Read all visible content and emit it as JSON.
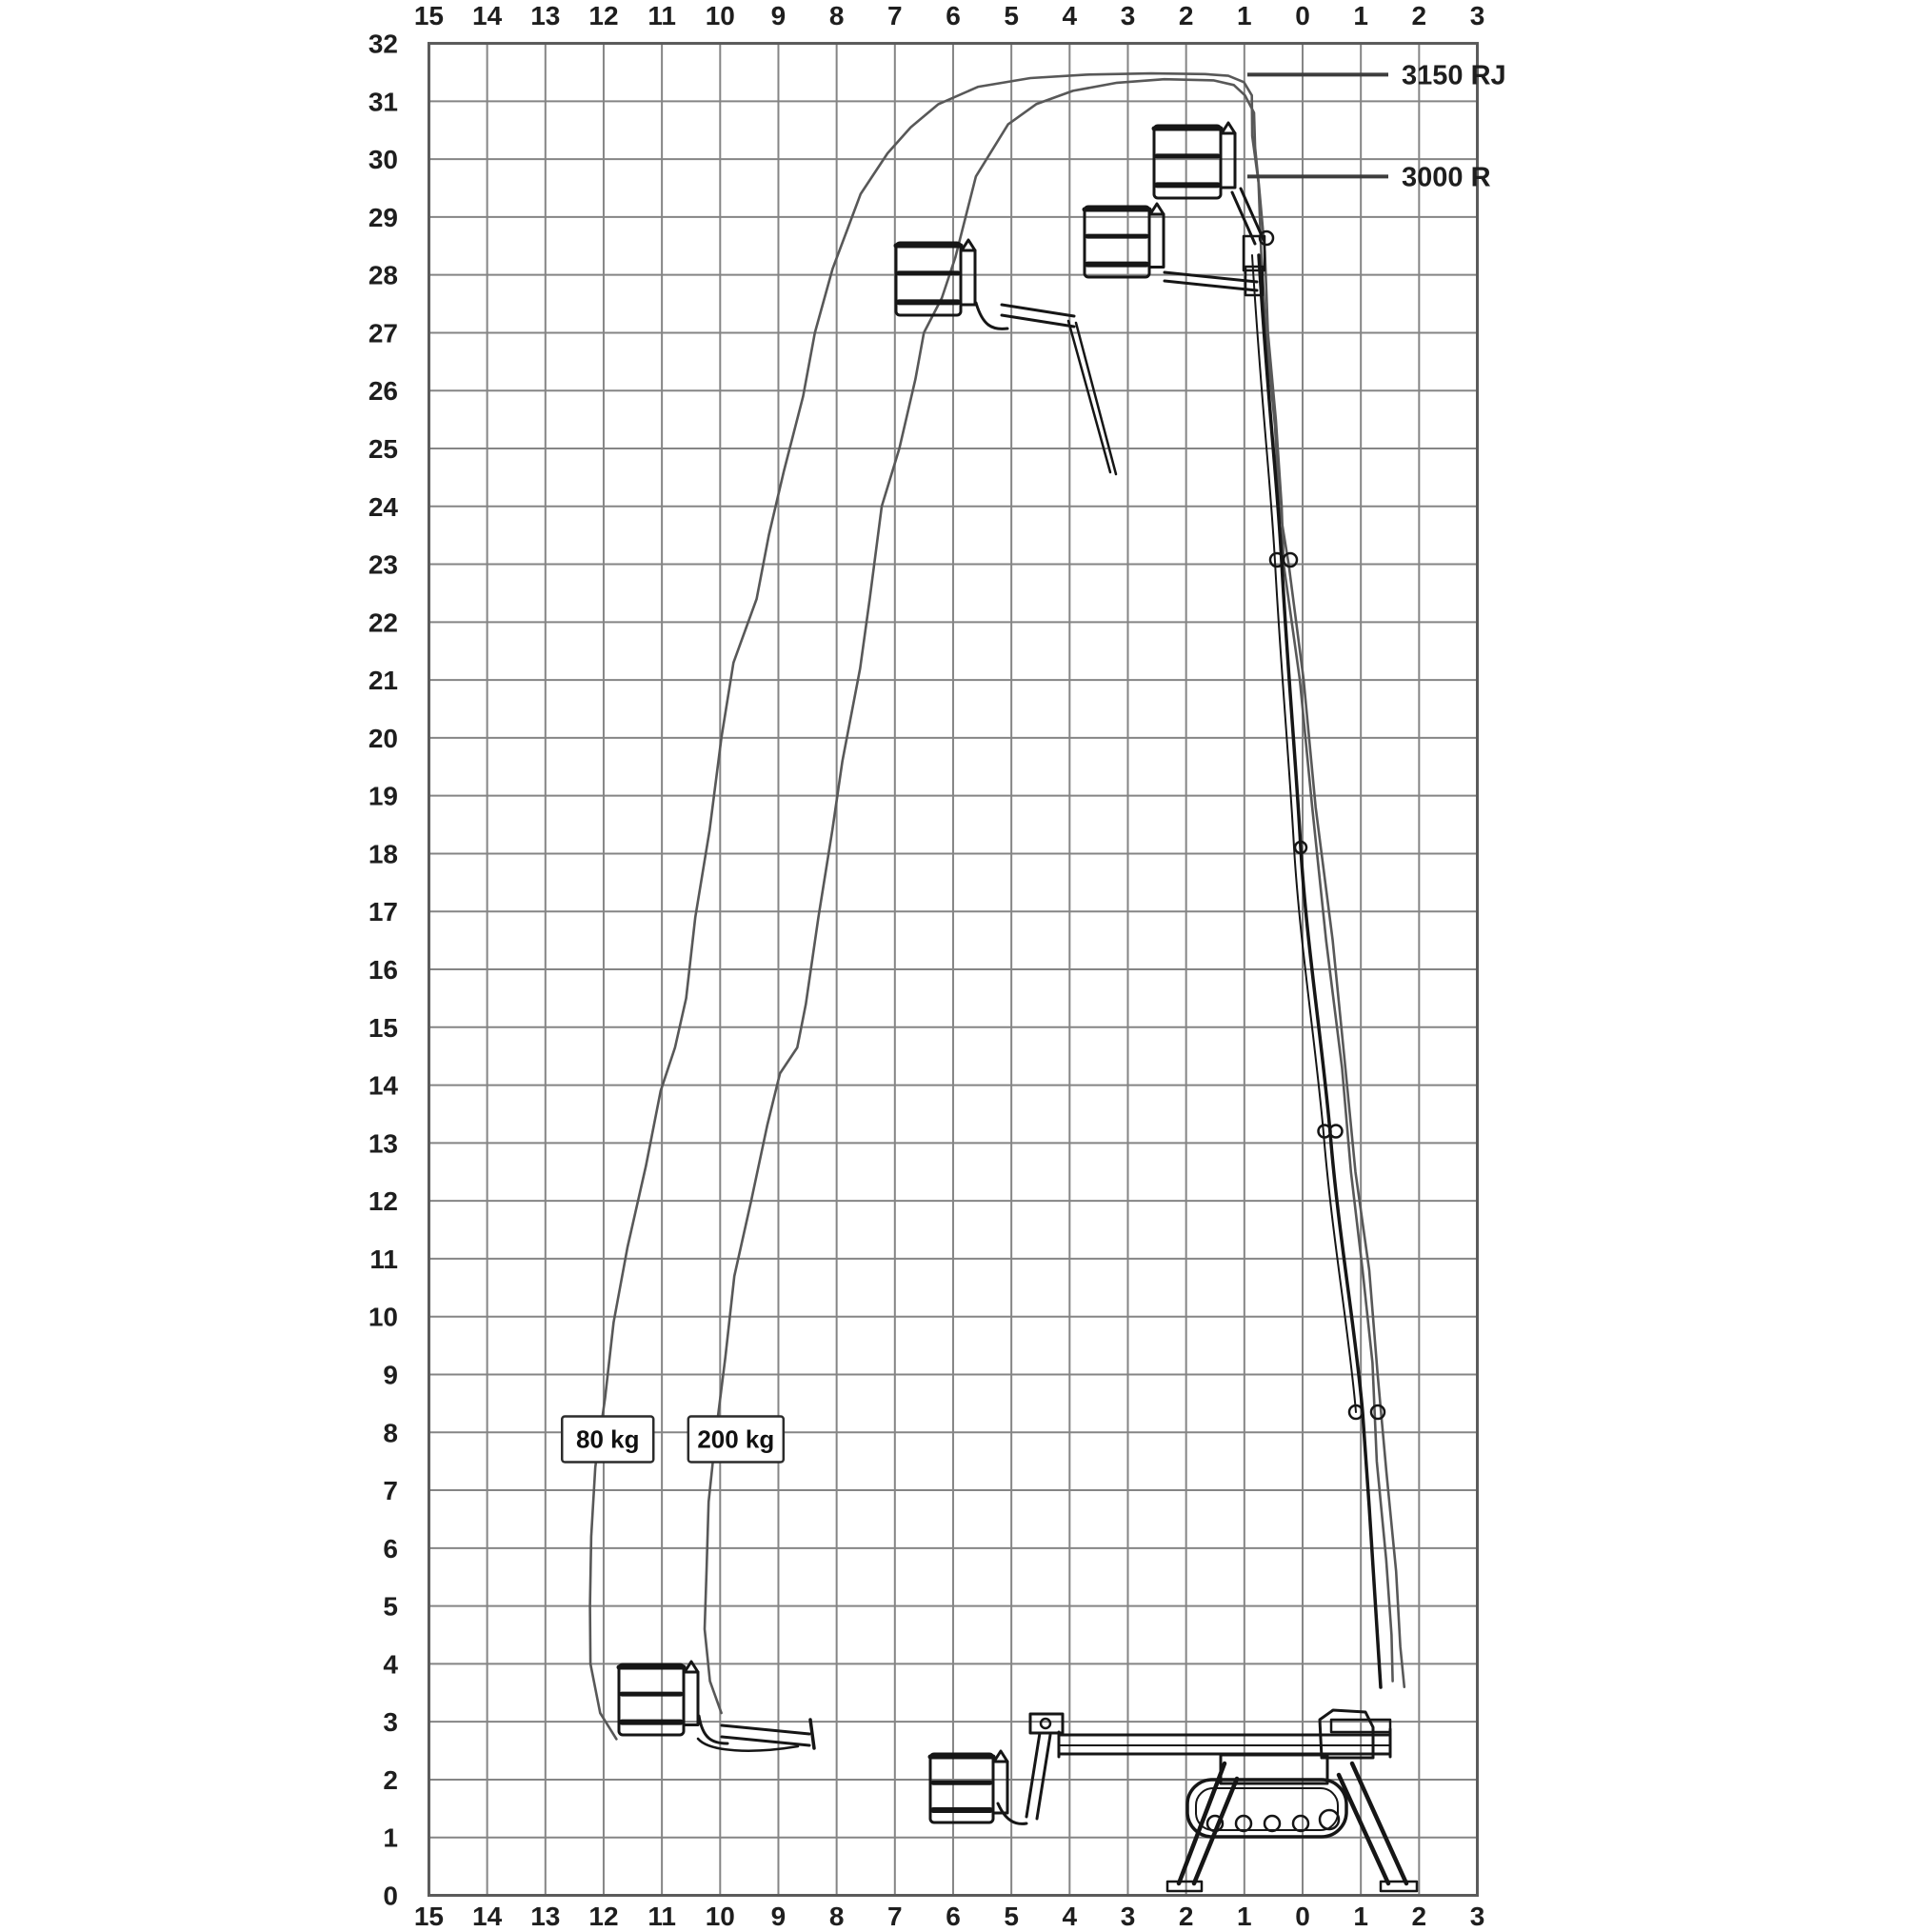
{
  "diagram_title": "Working envelope diagram",
  "model_labels": [
    {
      "text": "3150 RJ",
      "at_height_m": 31.46
    },
    {
      "text": "3000 R",
      "at_height_m": 29.7
    }
  ],
  "load_labels": [
    {
      "text": "80 kg",
      "x_m": 11.93,
      "y_m": 7.88
    },
    {
      "text": "200 kg",
      "x_m": 9.73,
      "y_m": 7.88
    }
  ],
  "chart_data": {
    "type": "line",
    "title": "",
    "xlabel": "",
    "ylabel": "",
    "grid": true,
    "x_axis": {
      "ticks_top": [
        "15",
        "14",
        "13",
        "12",
        "11",
        "10",
        "9",
        "8",
        "7",
        "6",
        "5",
        "4",
        "3",
        "2",
        "1",
        "0",
        "1",
        "2",
        "3"
      ],
      "ticks_bottom": [
        "15",
        "14",
        "13",
        "12",
        "11",
        "10",
        "9",
        "8",
        "7",
        "6",
        "5",
        "4",
        "3",
        "2",
        "1",
        "0",
        "1",
        "2",
        "3"
      ],
      "values_m": [
        15,
        14,
        13,
        12,
        11,
        10,
        9,
        8,
        7,
        6,
        5,
        4,
        3,
        2,
        1,
        0,
        -1,
        -2,
        -3
      ],
      "range_m": [
        15,
        -3
      ]
    },
    "y_axis": {
      "ticks_left": [
        "32",
        "31",
        "30",
        "29",
        "28",
        "27",
        "26",
        "25",
        "24",
        "23",
        "22",
        "21",
        "20",
        "19",
        "18",
        "17",
        "16",
        "15",
        "14",
        "13",
        "12",
        "11",
        "10",
        "9",
        "8",
        "7",
        "6",
        "5",
        "4",
        "3",
        "2",
        "1",
        "0"
      ],
      "values_m": [
        32,
        31,
        30,
        29,
        28,
        27,
        26,
        25,
        24,
        23,
        22,
        21,
        20,
        19,
        18,
        17,
        16,
        15,
        14,
        13,
        12,
        11,
        10,
        9,
        8,
        7,
        6,
        5,
        4,
        3,
        2,
        1,
        0
      ],
      "range_m": [
        0,
        32
      ]
    },
    "series": [
      {
        "name": "3150 RJ envelope — 80 kg",
        "load": "80 kg",
        "points": [
          [
            11.78,
            2.7
          ],
          [
            12.08,
            3.15
          ],
          [
            12.2,
            4.0
          ],
          [
            12.25,
            5.0
          ],
          [
            12.22,
            6.2
          ],
          [
            12.12,
            7.4
          ],
          [
            12.0,
            8.6
          ],
          [
            11.82,
            9.9
          ],
          [
            11.58,
            11.2
          ],
          [
            11.3,
            12.6
          ],
          [
            11.0,
            13.9
          ],
          [
            10.78,
            14.65
          ],
          [
            10.6,
            15.5
          ],
          [
            10.4,
            16.9
          ],
          [
            10.2,
            18.4
          ],
          [
            9.98,
            20.0
          ],
          [
            9.75,
            21.3
          ],
          [
            9.4,
            22.4
          ],
          [
            9.15,
            23.5
          ],
          [
            8.9,
            24.6
          ],
          [
            8.6,
            25.9
          ],
          [
            8.35,
            27.0
          ],
          [
            8.08,
            28.1
          ],
          [
            7.6,
            29.4
          ],
          [
            7.1,
            30.1
          ],
          [
            6.75,
            30.55
          ],
          [
            6.25,
            30.95
          ],
          [
            5.55,
            31.25
          ],
          [
            4.7,
            31.4
          ],
          [
            3.7,
            31.46
          ],
          [
            2.6,
            31.48
          ],
          [
            1.7,
            31.47
          ],
          [
            1.25,
            31.44
          ],
          [
            1.02,
            31.33
          ],
          [
            0.88,
            31.1
          ],
          [
            0.84,
            30.4
          ],
          [
            0.78,
            29.6
          ],
          [
            0.7,
            28.3
          ],
          [
            0.6,
            26.8
          ],
          [
            0.5,
            25.4
          ],
          [
            0.38,
            24.0
          ],
          [
            0.24,
            23.0
          ],
          [
            0.0,
            21.0
          ],
          [
            -0.25,
            18.8
          ],
          [
            -0.5,
            16.5
          ],
          [
            -0.73,
            14.3
          ],
          [
            -0.93,
            12.5
          ],
          [
            -1.12,
            10.8
          ],
          [
            -1.3,
            9.0
          ],
          [
            -1.45,
            7.3
          ],
          [
            -1.58,
            5.6
          ],
          [
            -1.7,
            4.3
          ],
          [
            -1.74,
            3.6
          ]
        ]
      },
      {
        "name": "3000 R envelope — 200 kg",
        "load": "200 kg",
        "points": [
          [
            10.0,
            3.15
          ],
          [
            10.17,
            3.7
          ],
          [
            10.25,
            4.6
          ],
          [
            10.26,
            5.6
          ],
          [
            10.18,
            6.8
          ],
          [
            10.07,
            8.0
          ],
          [
            9.93,
            9.3
          ],
          [
            9.73,
            10.7
          ],
          [
            9.48,
            12.0
          ],
          [
            9.2,
            13.3
          ],
          [
            8.95,
            14.2
          ],
          [
            8.7,
            14.65
          ],
          [
            8.52,
            15.4
          ],
          [
            8.3,
            16.9
          ],
          [
            8.1,
            18.4
          ],
          [
            7.88,
            19.6
          ],
          [
            7.6,
            21.2
          ],
          [
            7.45,
            22.4
          ],
          [
            7.2,
            24.0
          ],
          [
            6.94,
            25.0
          ],
          [
            6.65,
            26.2
          ],
          [
            6.48,
            27.0
          ],
          [
            6.22,
            27.6
          ],
          [
            5.95,
            28.3
          ],
          [
            5.6,
            29.7
          ],
          [
            5.08,
            30.6
          ],
          [
            4.55,
            30.95
          ],
          [
            3.95,
            31.18
          ],
          [
            3.2,
            31.32
          ],
          [
            2.35,
            31.38
          ],
          [
            1.55,
            31.36
          ],
          [
            1.18,
            31.28
          ],
          [
            0.97,
            31.1
          ],
          [
            0.86,
            30.8
          ],
          [
            0.8,
            30.2
          ],
          [
            0.74,
            29.5
          ],
          [
            0.67,
            28.4
          ],
          [
            0.57,
            27.0
          ],
          [
            0.47,
            25.5
          ],
          [
            0.37,
            24.0
          ],
          [
            0.3,
            23.0
          ],
          [
            0.07,
            21.0
          ],
          [
            -0.17,
            18.8
          ],
          [
            -0.42,
            16.5
          ],
          [
            -0.65,
            14.3
          ],
          [
            -0.85,
            12.5
          ],
          [
            -1.03,
            10.8
          ],
          [
            -1.18,
            9.2
          ],
          [
            -1.3,
            7.5
          ],
          [
            -1.42,
            5.8
          ],
          [
            -1.52,
            4.5
          ],
          [
            -1.57,
            3.7
          ]
        ]
      }
    ]
  },
  "colors": {
    "grid": "#858585",
    "border": "#5a5a5a",
    "envelope": "#585858",
    "machine": "#161616",
    "text": "#1e1e1e"
  }
}
